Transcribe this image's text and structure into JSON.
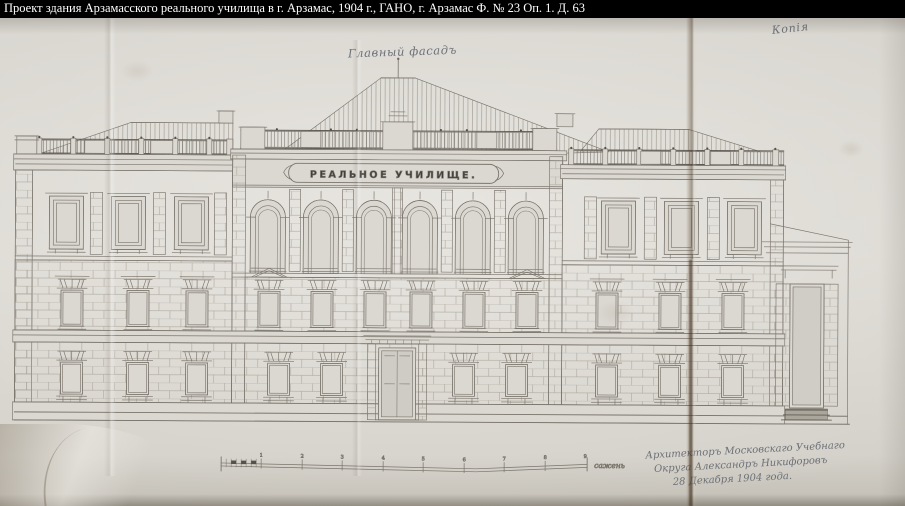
{
  "caption_bar": {
    "text": "Проект здания Арзамасского реального училища в г. Арзамас, 1904 г., ГАНО, г. Арзамас Ф. № 23 Оп. 1. Д. 63"
  },
  "annotations": {
    "page_number": "145",
    "facade_label": "Главный фасадъ",
    "copy_label": "Копія",
    "signature_line1": "Архитекторъ Московскаго Учебнаго",
    "signature_line2": "Округа Александръ Никифоровъ",
    "signature_line3": "28 Декабря 1904 года."
  },
  "building": {
    "sign_text": "РЕАЛЬНОЕ УЧИЛИЩЕ."
  },
  "scale_bar": {
    "unit_label": "сажень",
    "tick_labels": [
      "1",
      "2",
      "3",
      "4",
      "5",
      "6",
      "7",
      "8",
      "9"
    ]
  },
  "colors": {
    "caption_bg": "#000000",
    "caption_text": "#ffffff",
    "paper": "#d8d5cf",
    "ink_line": "#7a756c",
    "dark_accent": "#55504a",
    "handwriting_ink": "#6d7077",
    "sign_ink": "#3c3b38",
    "page_number_ink": "#a8716a"
  }
}
